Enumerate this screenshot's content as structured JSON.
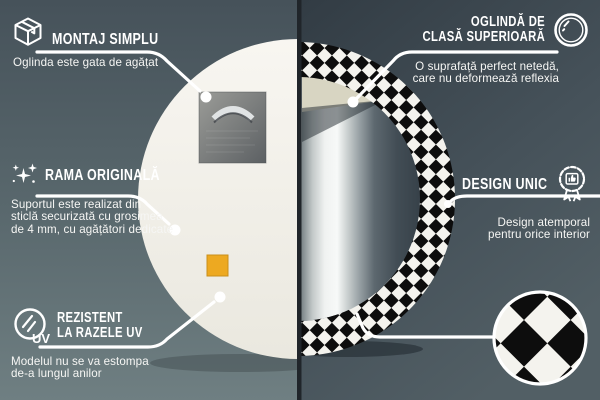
{
  "callouts": {
    "montaj": {
      "title": "MONTAJ SIMPLU",
      "subtitle": "Oglinda este gata de agățat"
    },
    "oglinda": {
      "title_line1": "OGLINDĂ DE",
      "title_line2": "CLASĂ SUPERIOARĂ",
      "subtitle_line1": "O suprafață perfect netedă,",
      "subtitle_line2": "care nu deformează reflexia"
    },
    "rama": {
      "title": "RAMA ORIGINALĂ",
      "subtitle_line1": "Suportul este realizat din",
      "subtitle_line2": "sticlă securizată cu grosimea",
      "subtitle_line3": "de 4 mm, cu agățători dedicate"
    },
    "design": {
      "title": "DESIGN UNIC",
      "subtitle_line1": "Design atemporal",
      "subtitle_line2": "pentru orice interior"
    },
    "uv": {
      "title_line1": "REZISTENT",
      "title_line2": "LA RAZELE UV",
      "icon_label": "UV",
      "subtitle_line1": "Modelul nu se va estompa",
      "subtitle_line2": "de-a lungul anilor"
    }
  },
  "icons": {
    "montaj": "package-box-icon",
    "oglinda": "mirror-shine-icon",
    "rama": "sparkles-icon",
    "design": "award-badge-icon",
    "uv": "uv-sun-icon",
    "swatch": "checkered-pattern-swatch"
  },
  "colors": {
    "background_left": "#55646a",
    "background_right": "#3c4851",
    "callout_text": "#ffffff",
    "callout_line": "#ffffff",
    "mirror_back": "#f3f1ea",
    "accent_orange": "#eda921",
    "pattern_black": "#0d0d0d",
    "pattern_white": "#f4f3ee"
  }
}
